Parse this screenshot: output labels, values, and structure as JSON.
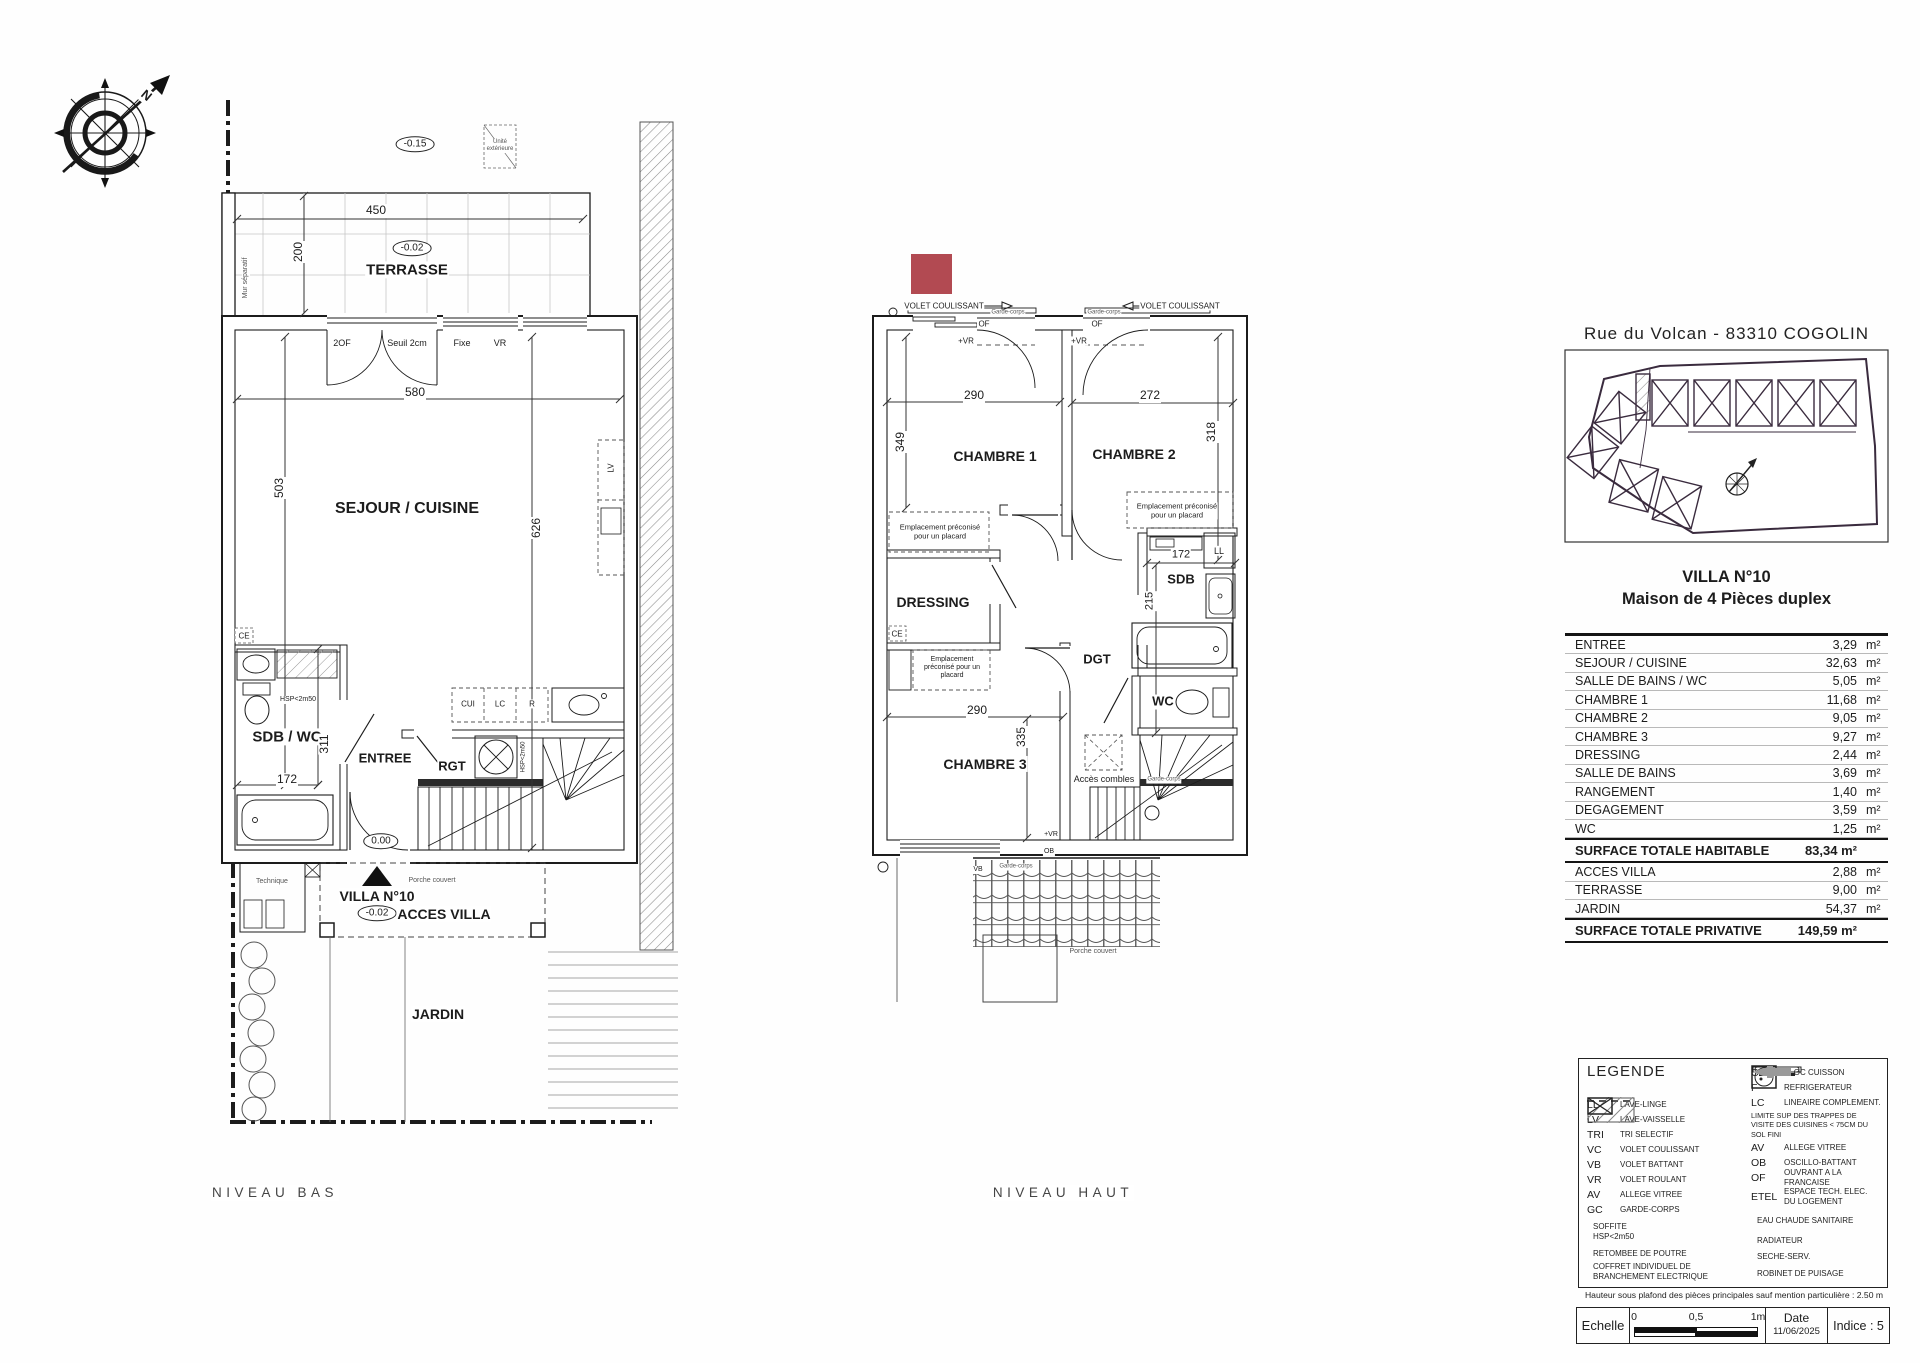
{
  "colors": {
    "ink": "#1c1c1c",
    "red_marker": "#b24a52",
    "caption": "#454545"
  },
  "header": {
    "address": "Rue du Volcan - 83310 COGOLIN"
  },
  "villa": {
    "title": "VILLA N°10",
    "subtitle": "Maison de 4 Pièces duplex"
  },
  "area_table": {
    "unit": "m²",
    "rows_main": [
      {
        "label": "ENTREE",
        "value": "3,29"
      },
      {
        "label": "SEJOUR / CUISINE",
        "value": "32,63"
      },
      {
        "label": "SALLE DE BAINS / WC",
        "value": "5,05"
      },
      {
        "label": "CHAMBRE 1",
        "value": "11,68"
      },
      {
        "label": "CHAMBRE 2",
        "value": "9,05"
      },
      {
        "label": "CHAMBRE 3",
        "value": "9,27"
      },
      {
        "label": "DRESSING",
        "value": "2,44"
      },
      {
        "label": "SALLE DE BAINS",
        "value": "3,69"
      },
      {
        "label": "RANGEMENT",
        "value": "1,40"
      },
      {
        "label": "DEGAGEMENT",
        "value": "3,59"
      },
      {
        "label": "WC",
        "value": "1,25"
      }
    ],
    "total_habitable": {
      "label": "SURFACE TOTALE HABITABLE",
      "value": "83,34 m²"
    },
    "rows_ext": [
      {
        "label": "ACCES VILLA",
        "value": "2,88"
      },
      {
        "label": "TERRASSE",
        "value": "9,00"
      },
      {
        "label": "JARDIN",
        "value": "54,37"
      }
    ],
    "total_privative": {
      "label": "SURFACE TOTALE PRIVATIVE",
      "value": "149,59 m²"
    }
  },
  "legend": {
    "title": "LEGENDE",
    "left": [
      {
        "code": "LL",
        "desc": "LAVE-LINGE"
      },
      {
        "code": "LV",
        "desc": "LAVE-VAISSELLE"
      },
      {
        "code": "TRI",
        "desc": "TRI SELECTIF"
      },
      {
        "code": "VC",
        "desc": "VOLET COULISSANT"
      },
      {
        "code": "VB",
        "desc": "VOLET BATTANT"
      },
      {
        "code": "VR",
        "desc": "VOLET ROULANT"
      },
      {
        "code": "AV",
        "desc": "ALLEGE VITREE"
      },
      {
        "code": "GC",
        "desc": "GARDE-CORPS"
      },
      {
        "icon": "soffite",
        "desc": "SOFFITE\nHSP<2m50"
      },
      {
        "icon": "dashes",
        "desc": "RETOMBEE DE POUTRE"
      },
      {
        "icon": "coffret",
        "desc": "COFFRET INDIVIDUEL DE\nBRANCHEMENT ELECTRIQUE"
      }
    ],
    "right": [
      {
        "code": "CUI",
        "desc": "BLOC CUISSON"
      },
      {
        "code": "F",
        "desc": "REFRIGERATEUR"
      },
      {
        "code": "LC",
        "desc": "LINEAIRE COMPLEMENT."
      },
      {
        "note": "LIMITE SUP DES TRAPPES DE\nVISITE DES CUISINES < 75CM DU\nSOL FINI"
      },
      {
        "code": "AV",
        "desc": "ALLEGE VITREE"
      },
      {
        "code": "OB",
        "desc": "OSCILLO-BATTANT"
      },
      {
        "code": "OF",
        "desc": "OUVRANT A LA FRANCAISE"
      },
      {
        "code": "ETEL",
        "desc": "ESPACE TECH. ELEC.\nDU LOGEMENT"
      },
      {
        "icon": "ecs",
        "desc": "EAU CHAUDE SANITAIRE"
      },
      {
        "icon": "radiateur",
        "desc": "RADIATEUR"
      },
      {
        "icon": "seche",
        "desc": "SECHE-SERV."
      },
      {
        "icon": "robinet",
        "desc": "ROBINET DE PUISAGE"
      }
    ]
  },
  "footer": {
    "note": "Hauteur sous plafond des pièces principales sauf mention particulière : 2.50 m",
    "echelle_label": "Echelle",
    "scale_ticks": [
      "0",
      "0,5",
      "1m"
    ],
    "date_label": "Date",
    "date_value": "11/06/2025",
    "indice": "Indice : 5"
  },
  "plan_labels": [
    {
      "t": "N",
      "x": 146,
      "y": 96,
      "fs": 13,
      "fw": 700,
      "rot": 40,
      "n": "compass-north-label"
    },
    {
      "t": "-0.15",
      "x": 415,
      "y": 144,
      "fs": 10,
      "oval": true,
      "n": "elevation-marker"
    },
    {
      "t": "450",
      "x": 376,
      "y": 211,
      "fs": 12,
      "n": "dim-label"
    },
    {
      "t": "200",
      "x": 299,
      "y": 252,
      "fs": 12,
      "rot": -90,
      "n": "dim-label"
    },
    {
      "t": "-0.02",
      "x": 412,
      "y": 248,
      "fs": 10,
      "oval": true,
      "n": "elevation-marker"
    },
    {
      "t": "TERRASSE",
      "x": 407,
      "y": 270,
      "fs": 15,
      "fw": 700,
      "n": "room-terrasse"
    },
    {
      "t": "Mur séparatif",
      "x": 246,
      "y": 278,
      "fs": 7,
      "rot": -90,
      "c": "#555",
      "n": "note-mur-separatif"
    },
    {
      "t": "Unité\nextérieure",
      "x": 500,
      "y": 146,
      "fs": 6,
      "c": "#555",
      "n": "note-unite-exterieure"
    },
    {
      "t": "2OF",
      "x": 342,
      "y": 343,
      "fs": 9,
      "n": "opening-label"
    },
    {
      "t": "Seuil 2cm",
      "x": 407,
      "y": 343,
      "fs": 9,
      "n": "opening-label"
    },
    {
      "t": "Fixe",
      "x": 462,
      "y": 343,
      "fs": 9,
      "n": "opening-label"
    },
    {
      "t": "VR",
      "x": 500,
      "y": 343,
      "fs": 9,
      "n": "opening-label"
    },
    {
      "t": "580",
      "x": 415,
      "y": 393,
      "fs": 12,
      "n": "dim-label"
    },
    {
      "t": "503",
      "x": 280,
      "y": 488,
      "fs": 12,
      "rot": -90,
      "n": "dim-label"
    },
    {
      "t": "626",
      "x": 537,
      "y": 528,
      "fs": 12,
      "rot": -90,
      "n": "dim-label"
    },
    {
      "t": "SEJOUR / CUISINE",
      "x": 407,
      "y": 509,
      "fs": 16,
      "fw": 700,
      "n": "room-sejour-cuisine"
    },
    {
      "t": "LV",
      "x": 611,
      "y": 468,
      "fs": 8,
      "rot": -90,
      "n": "fixture-label"
    },
    {
      "t": "CE",
      "x": 244,
      "y": 636,
      "fs": 8,
      "n": "fixture-label"
    },
    {
      "t": "HSP<2m50",
      "x": 298,
      "y": 700,
      "fs": 7,
      "n": "note-hsp"
    },
    {
      "t": "SDB / WC",
      "x": 287,
      "y": 737,
      "fs": 15,
      "fw": 700,
      "n": "room-sdb-wc"
    },
    {
      "t": "311",
      "x": 325,
      "y": 744,
      "fs": 12,
      "rot": -90,
      "n": "dim-label"
    },
    {
      "t": "172",
      "x": 287,
      "y": 780,
      "fs": 12,
      "n": "dim-label"
    },
    {
      "t": "ENTREE",
      "x": 385,
      "y": 759,
      "fs": 13,
      "fw": 700,
      "n": "room-entree"
    },
    {
      "t": "RGT",
      "x": 452,
      "y": 767,
      "fs": 13,
      "fw": 700,
      "n": "room-rgt"
    },
    {
      "t": "HSP<2m50",
      "x": 524,
      "y": 757,
      "fs": 6,
      "rot": -90,
      "n": "note-hsp"
    },
    {
      "t": "CUI",
      "x": 468,
      "y": 704,
      "fs": 8,
      "n": "fixture-label"
    },
    {
      "t": "LC",
      "x": 500,
      "y": 704,
      "fs": 8,
      "n": "fixture-label"
    },
    {
      "t": "R",
      "x": 532,
      "y": 704,
      "fs": 8,
      "n": "fixture-label"
    },
    {
      "t": "0.00",
      "x": 381,
      "y": 841,
      "fs": 10,
      "oval": true,
      "n": "elevation-marker"
    },
    {
      "t": "VILLA N°10",
      "x": 377,
      "y": 896,
      "fs": 14,
      "fw": 700,
      "n": "villa-entrance-label"
    },
    {
      "t": "Porche couvert",
      "x": 432,
      "y": 881,
      "fs": 7,
      "c": "#555",
      "n": "note-porche"
    },
    {
      "t": "-0.02",
      "x": 377,
      "y": 913,
      "fs": 10,
      "oval": true,
      "n": "elevation-marker"
    },
    {
      "t": "ACCES VILLA",
      "x": 444,
      "y": 914,
      "fs": 14,
      "fw": 700,
      "n": "room-acces-villa"
    },
    {
      "t": "Technique",
      "x": 272,
      "y": 882,
      "fs": 7,
      "c": "#555",
      "n": "note-technique"
    },
    {
      "t": "JARDIN",
      "x": 438,
      "y": 1014,
      "fs": 14,
      "fw": 700,
      "n": "room-jardin"
    },
    {
      "t": "NIVEAU BAS",
      "x": 275,
      "y": 1193,
      "fs": 13.5,
      "ls": 4.5,
      "c": "#454545",
      "n": "caption-niveau-bas"
    },
    {
      "t": "VOLET COULISSANT",
      "x": 944,
      "y": 306,
      "fs": 8,
      "n": "opening-label"
    },
    {
      "t": "VOLET COULISSANT",
      "x": 1180,
      "y": 306,
      "fs": 8,
      "n": "opening-label"
    },
    {
      "t": "Garde-corps",
      "x": 1008,
      "y": 313,
      "fs": 6,
      "c": "#555",
      "n": "note-garde-corps"
    },
    {
      "t": "Garde-corps",
      "x": 1104,
      "y": 313,
      "fs": 6,
      "c": "#555",
      "n": "note-garde-corps"
    },
    {
      "t": "OF",
      "x": 984,
      "y": 324,
      "fs": 8,
      "n": "opening-label"
    },
    {
      "t": "OF",
      "x": 1097,
      "y": 324,
      "fs": 8,
      "n": "opening-label"
    },
    {
      "t": "+VR",
      "x": 966,
      "y": 341,
      "fs": 8,
      "n": "opening-label"
    },
    {
      "t": "+VR",
      "x": 1079,
      "y": 341,
      "fs": 8,
      "n": "opening-label"
    },
    {
      "t": "290",
      "x": 974,
      "y": 396,
      "fs": 12,
      "n": "dim-label"
    },
    {
      "t": "272",
      "x": 1150,
      "y": 396,
      "fs": 12,
      "n": "dim-label"
    },
    {
      "t": "349",
      "x": 901,
      "y": 442,
      "fs": 12,
      "rot": -90,
      "n": "dim-label"
    },
    {
      "t": "318",
      "x": 1212,
      "y": 432,
      "fs": 12,
      "rot": -90,
      "n": "dim-label"
    },
    {
      "t": "CHAMBRE 1",
      "x": 995,
      "y": 456,
      "fs": 14,
      "fw": 700,
      "n": "room-chambre-1"
    },
    {
      "t": "CHAMBRE 2",
      "x": 1134,
      "y": 454,
      "fs": 14,
      "fw": 700,
      "n": "room-chambre-2"
    },
    {
      "t": "Emplacement préconisé\npour un placard",
      "x": 940,
      "y": 532,
      "fs": 7.5,
      "n": "note-placard"
    },
    {
      "t": "Emplacement préconisé\npour un placard",
      "x": 1177,
      "y": 511,
      "fs": 7.5,
      "n": "note-placard"
    },
    {
      "t": "DRESSING",
      "x": 933,
      "y": 602,
      "fs": 14,
      "fw": 700,
      "n": "room-dressing"
    },
    {
      "t": "CE",
      "x": 897,
      "y": 634,
      "fs": 8,
      "n": "fixture-label"
    },
    {
      "t": "Emplacement\npréconisé pour un\nplacard",
      "x": 952,
      "y": 668,
      "fs": 7,
      "n": "note-placard"
    },
    {
      "t": "LL",
      "x": 1219,
      "y": 551,
      "fs": 9,
      "n": "fixture-label"
    },
    {
      "t": "172",
      "x": 1181,
      "y": 555,
      "fs": 11,
      "n": "dim-label"
    },
    {
      "t": "SDB",
      "x": 1181,
      "y": 580,
      "fs": 13,
      "fw": 700,
      "n": "room-sdb"
    },
    {
      "t": "215",
      "x": 1150,
      "y": 601,
      "fs": 11,
      "rot": -90,
      "n": "dim-label"
    },
    {
      "t": "DGT",
      "x": 1097,
      "y": 660,
      "fs": 13,
      "fw": 700,
      "n": "room-dgt"
    },
    {
      "t": "WC",
      "x": 1163,
      "y": 702,
      "fs": 13,
      "fw": 700,
      "n": "room-wc"
    },
    {
      "t": "290",
      "x": 977,
      "y": 711,
      "fs": 12,
      "n": "dim-label"
    },
    {
      "t": "335",
      "x": 1022,
      "y": 737,
      "fs": 12,
      "rot": -90,
      "n": "dim-label"
    },
    {
      "t": "CHAMBRE 3",
      "x": 985,
      "y": 764,
      "fs": 14,
      "fw": 700,
      "n": "room-chambre-3"
    },
    {
      "t": "Accès combles",
      "x": 1104,
      "y": 779,
      "fs": 9,
      "n": "note-acces-combles"
    },
    {
      "t": "Garde-corps",
      "x": 1164,
      "y": 780,
      "fs": 6,
      "c": "#555",
      "n": "note-garde-corps"
    },
    {
      "t": "+VR",
      "x": 1051,
      "y": 835,
      "fs": 7,
      "n": "opening-label"
    },
    {
      "t": "OB",
      "x": 1049,
      "y": 852,
      "fs": 7,
      "n": "opening-label"
    },
    {
      "t": "VB",
      "x": 978,
      "y": 870,
      "fs": 7,
      "n": "opening-label"
    },
    {
      "t": "Garde-corps",
      "x": 1016,
      "y": 867,
      "fs": 6,
      "c": "#555",
      "n": "note-garde-corps"
    },
    {
      "t": "Porche couvert",
      "x": 1093,
      "y": 952,
      "fs": 7,
      "c": "#555",
      "n": "note-porche"
    },
    {
      "t": "NIVEAU HAUT",
      "x": 1063,
      "y": 1193,
      "fs": 13.5,
      "ls": 4.5,
      "c": "#454545",
      "n": "caption-niveau-haut"
    }
  ]
}
